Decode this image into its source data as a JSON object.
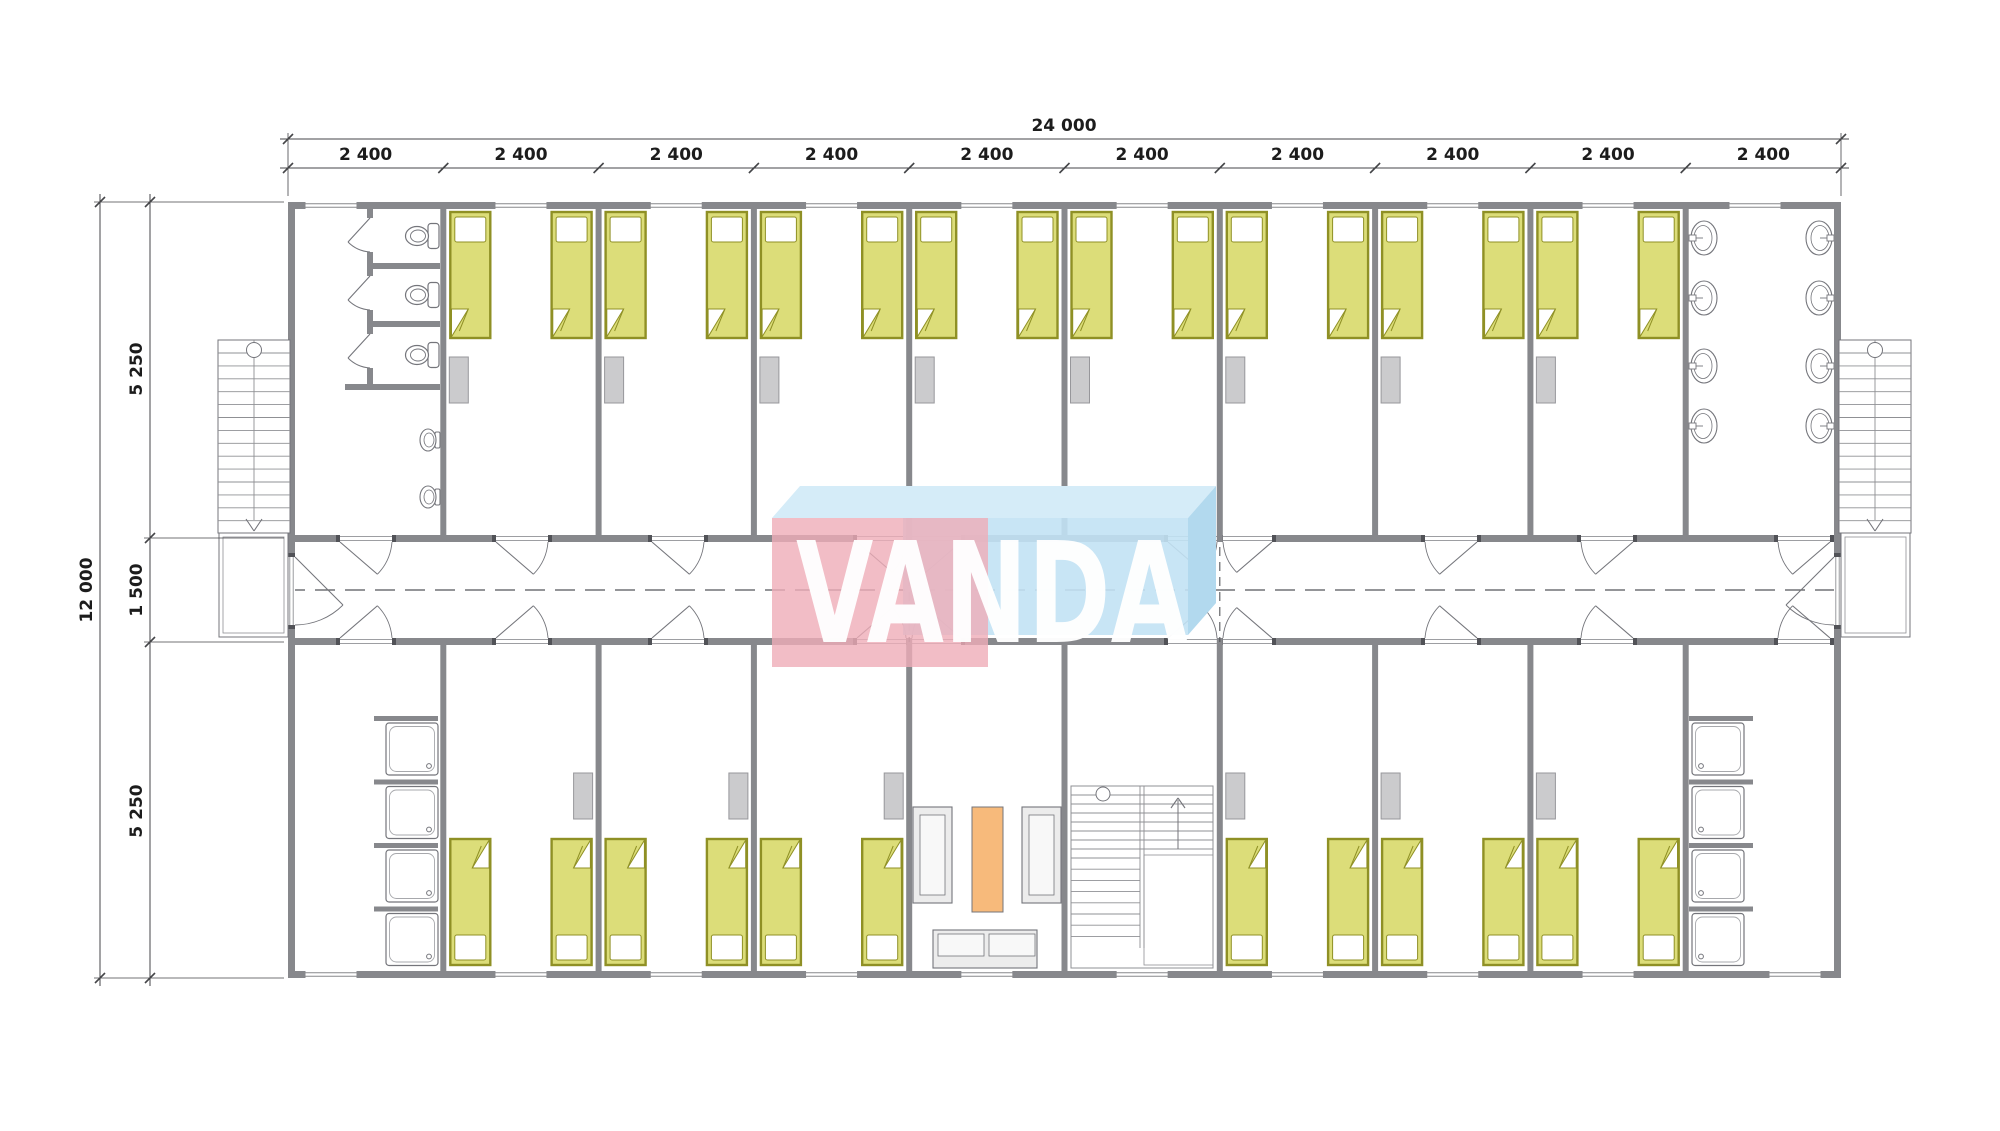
{
  "watermark": {
    "text": "VANDA",
    "pink_color": "#efacb8",
    "blue_color": "#c2e2f4",
    "top_face_color": "#d5ecf8",
    "side_face_color": "#b2d9ee"
  },
  "dimensions": {
    "total_width_label": "24 000",
    "width_segment_labels": [
      "2 400",
      "2 400",
      "2 400",
      "2 400",
      "2 400",
      "2 400",
      "2 400",
      "2 400",
      "2 400",
      "2 400"
    ],
    "total_height_label": "12 000",
    "height_segment_labels": [
      "5 250",
      "1 500",
      "5 250"
    ]
  },
  "colors": {
    "wall": "#87888c",
    "jamb": "#515257",
    "line": "#74757b",
    "thin_line": "#8f9094",
    "dash_line": "#55565a",
    "bed_fill": "#dcdd79",
    "bed_stroke": "#8f9025",
    "cabinet_fill": "#cbcbcd",
    "cabinet_stroke": "#97979b",
    "table_fill": "#f7ba7b",
    "furniture_fill": "#ececec",
    "dim_text": "#1c1c1c",
    "dim_line": "#444548"
  },
  "plan": {
    "modules": 10,
    "top_rooms": [
      "toilets",
      "bedroom",
      "bedroom",
      "bedroom",
      "bedroom",
      "bedroom",
      "bedroom",
      "bedroom",
      "bedroom",
      "washroom"
    ],
    "bottom_rooms": [
      "showers",
      "bedroom",
      "bedroom",
      "bedroom",
      "lounge",
      "staircase",
      "bedroom",
      "bedroom",
      "bedroom",
      "showers"
    ],
    "beds_per_bedroom": 2,
    "toilet_stalls": 3,
    "urinals": 2,
    "washbasins": 8,
    "showers_per_room": 4
  }
}
